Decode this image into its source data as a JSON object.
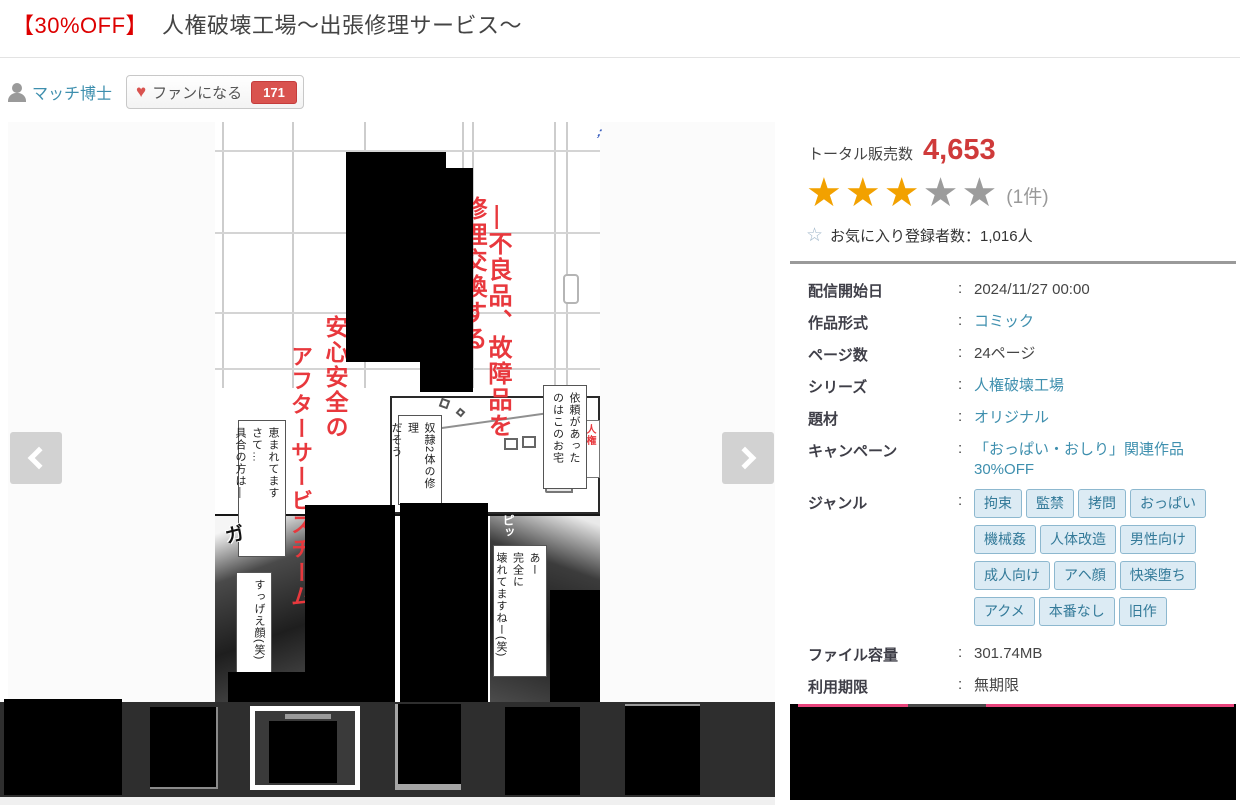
{
  "header": {
    "discount": "【30%OFF】",
    "title": "人権破壊工場～出張修理サービス～"
  },
  "maker": {
    "name": "マッチ博士",
    "fan_button_label": "ファンになる",
    "fan_count": "171",
    "heart_icon": "♥"
  },
  "stats": {
    "sales_label": "トータル販売数",
    "sales_value": "4,653",
    "star_icon": "★",
    "star_outline_icon": "☆",
    "rating_count": "(1件)",
    "favorites_text": "お気に入り登録者数：1,016人"
  },
  "info": {
    "colon": ":",
    "rows": [
      {
        "label": "配信開始日",
        "value": "2024/11/27 00:00"
      },
      {
        "label": "作品形式",
        "value": "コミック"
      },
      {
        "label": "ページ数",
        "value": "24ページ"
      },
      {
        "label": "シリーズ",
        "value": "人権破壊工場"
      },
      {
        "label": "題材",
        "value": "オリジナル"
      },
      {
        "label": "キャンペーン",
        "value": "「おっぱい・おしり」関連作品30%OFF"
      }
    ],
    "genre_label": "ジャンル",
    "genres": [
      "拘束",
      "監禁",
      "拷問",
      "おっぱい",
      "機械姦",
      "人体改造",
      "男性向け",
      "成人向け",
      "アヘ顔",
      "快楽堕ち",
      "アクメ",
      "本番なし",
      "旧作"
    ],
    "file_label": "ファイル容量",
    "file_value": "301.74MB",
    "expiry_label": "利用期限",
    "expiry_value": "無期限"
  },
  "preview": {
    "catch_right_1": "―不良品、故障品を",
    "catch_right_2": "修理交換する",
    "catch_left_1": "安心安全の",
    "catch_left_2": "アフターサービスチーム",
    "bubble_house_right": "依頼があった\nのはこのお宅",
    "bubble_house_mid": "奴隷2体の修理\nだそう",
    "bubble_house_left": "恵まれてます\nさて…\n具合の方は―",
    "bubble_face": "すっげえ顔(笑)",
    "bubble_broken": "あー\n完全に\n壊れてますねー(笑)",
    "truck_label": "人権\n破壊号",
    "sfx_ga": "ガ",
    "sfx_pi": "ピッ",
    "corner_mark": ";"
  },
  "colors": {
    "accent_red": "#dd0000",
    "sales_red": "#cf3a3a",
    "link_teal": "#3e8fae",
    "star_gold": "#f2a100",
    "badge_red": "#d9534f",
    "pink_line": "#e8447c"
  }
}
